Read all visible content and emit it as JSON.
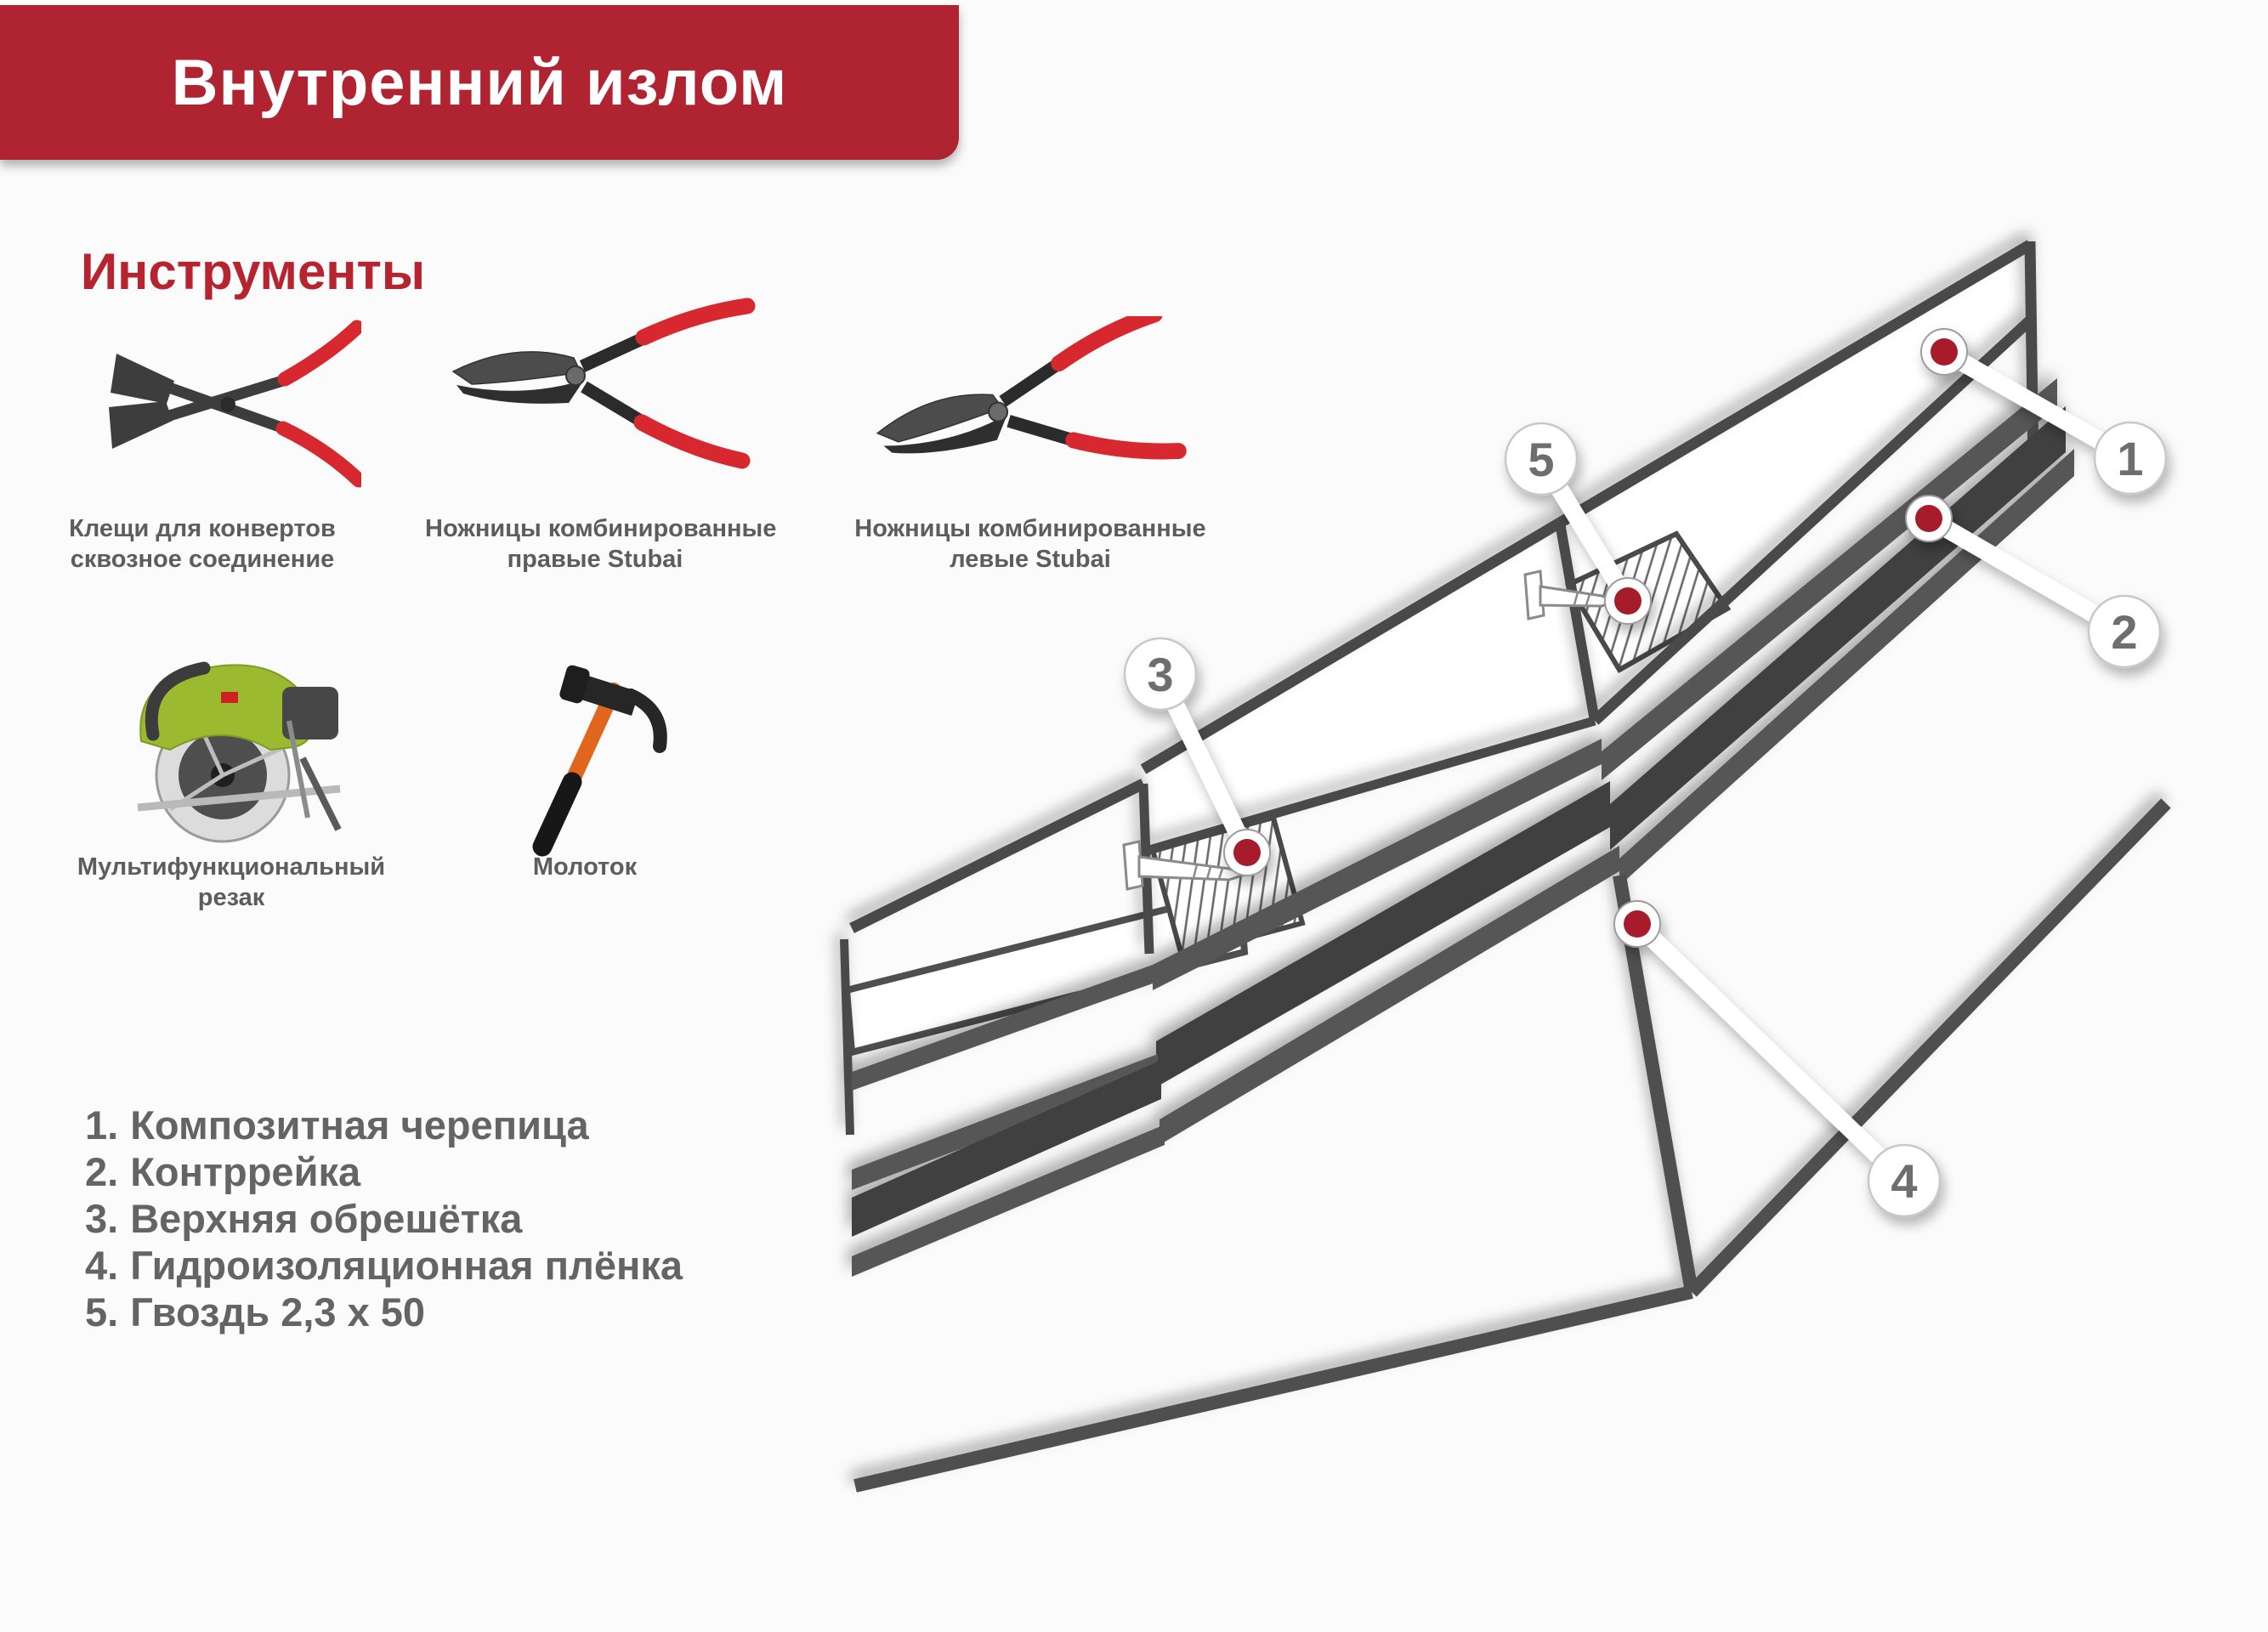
{
  "header": {
    "title": "Внутренний излом",
    "bg_color": "#b02431",
    "text_color": "#ffffff"
  },
  "tools_section": {
    "heading": "Инструменты",
    "heading_color": "#b5242f",
    "items": [
      {
        "icon": "envelope-pliers-icon",
        "line1": "Клещи для конвертов",
        "line2": "сквозное соединение"
      },
      {
        "icon": "combination-snips-right-icon",
        "line1": "Ножницы комбинированные",
        "line2": "правые Stubai"
      },
      {
        "icon": "combination-snips-left-icon",
        "line1": "Ножницы комбинированные",
        "line2": "левые Stubai"
      },
      {
        "icon": "multifunction-cutter-icon",
        "line1": "Мультифункциональный",
        "line2": "резак"
      },
      {
        "icon": "hammer-icon",
        "line1": "Молоток",
        "line2": ""
      }
    ]
  },
  "legend": {
    "text_color": "#646464",
    "items": [
      {
        "num": "1.",
        "text": "Композитная черепица"
      },
      {
        "num": "2.",
        "text": "Контррейка"
      },
      {
        "num": "3.",
        "text": "Верхняя обрешётка"
      },
      {
        "num": "4.",
        "text": "Гидроизоляционная плёнка"
      },
      {
        "num": "5.",
        "text": "Гвоздь 2,3 х 50"
      }
    ]
  },
  "diagram": {
    "dot_color": "#a61e2c",
    "line_color": "#4a4a4a",
    "band_color": "#575757",
    "dark_band_color": "#3f3f3f",
    "callouts": [
      {
        "num": "1"
      },
      {
        "num": "2"
      },
      {
        "num": "3"
      },
      {
        "num": "4"
      },
      {
        "num": "5"
      }
    ]
  }
}
